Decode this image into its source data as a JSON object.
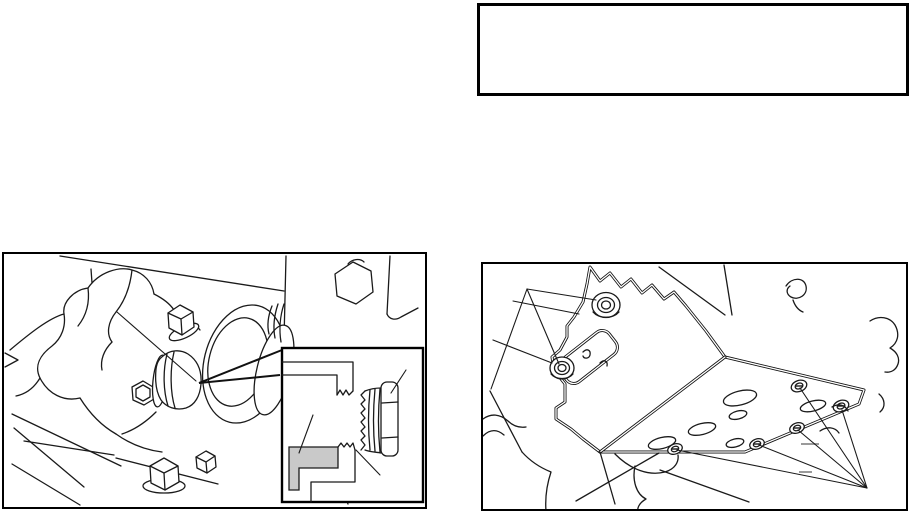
{
  "page": {
    "kind": "service-manual-scanned-page",
    "background_color": "#ffffff",
    "ink_color": "#1a1a1a"
  },
  "note_box": {
    "content": "",
    "border_color": "#000000"
  },
  "figures": {
    "left": {
      "name": "drain-plug-sectional-detail-figure",
      "border_color": "#000000",
      "inset": {
        "name": "plug-thread-sealant-cross-section-inset",
        "highlight_color": "#c9c9c9"
      }
    },
    "right": {
      "name": "skid-plate-mounting-bolts-figure",
      "border_color": "#000000"
    }
  }
}
